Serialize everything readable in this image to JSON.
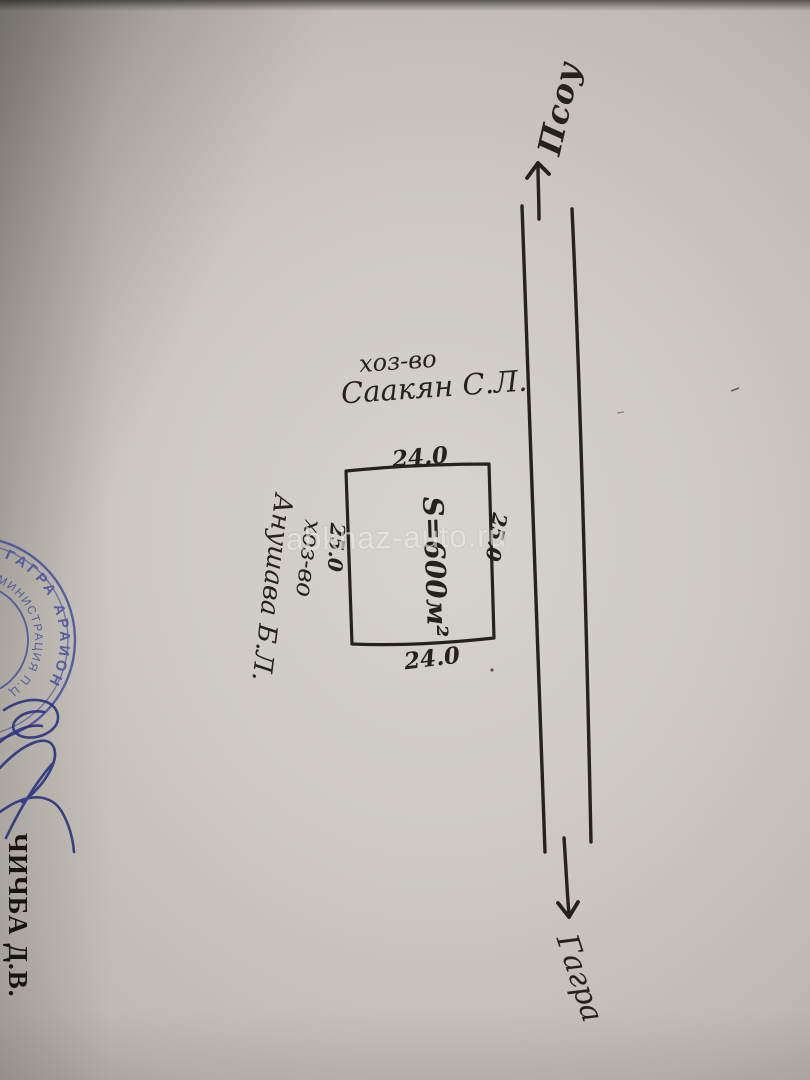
{
  "labels": {
    "direction_left": "Псоу",
    "direction_right": "Гагра",
    "neighbor_top": {
      "line1": "хоз-во",
      "line2": "Саакян С.Л."
    },
    "neighbor_left": {
      "line1": "хоз-во",
      "line2": "Анушава Б.Л."
    },
    "plot_area": "S=600м²",
    "dim_top": "24.0",
    "dim_bottom": "24.0",
    "dim_left": "25.0",
    "dim_right": "25.0"
  },
  "watermark": {
    "text": "abkhaz-auto.ru"
  },
  "stamp": {
    "outer_ring_text": "ГАГРА АРАИОН",
    "inner_ring_text": "АДМИНИСТРАЦИЯ П.Ц",
    "ink_color": "#3d479c"
  },
  "signature": {
    "ink_color": "#28307e"
  },
  "officials": {
    "name": "ЧИЧБА Д.В."
  },
  "colors": {
    "pen_ink": "#25221d",
    "paper_highlight": "#d7d4cd",
    "paper_shadow": "#8e8a82"
  }
}
